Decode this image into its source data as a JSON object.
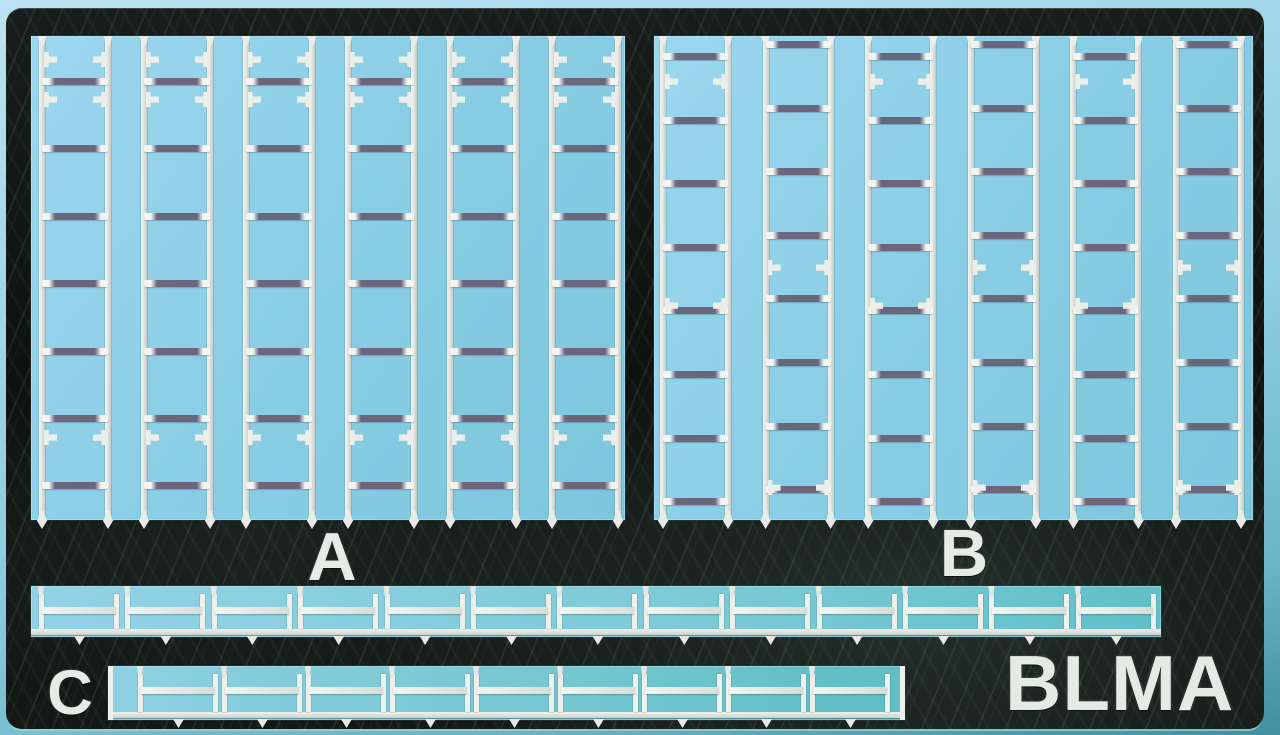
{
  "photo_subject": "photo-etched silver metal detail fret (model railroad ladders) on light blue backing",
  "brand": {
    "logo_text": "BLMA"
  },
  "colors": {
    "backing_blue": "#8bcee6",
    "backing_teal_edge": "#418fa0",
    "fret_dark": "#0d1110",
    "metal_silver": "#eceee9",
    "rung_shadow": "#6b657e",
    "lettering": "#e7ebe6"
  },
  "sections": {
    "a": {
      "label": "A",
      "ladder_count": 6,
      "rungs_per_ladder": 7
    },
    "b": {
      "label": "B",
      "ladder_count": 6,
      "rungs_per_ladder": 8
    },
    "c": {
      "label": "C",
      "strip1_part_count": 13,
      "strip2_part_count": 9
    }
  }
}
